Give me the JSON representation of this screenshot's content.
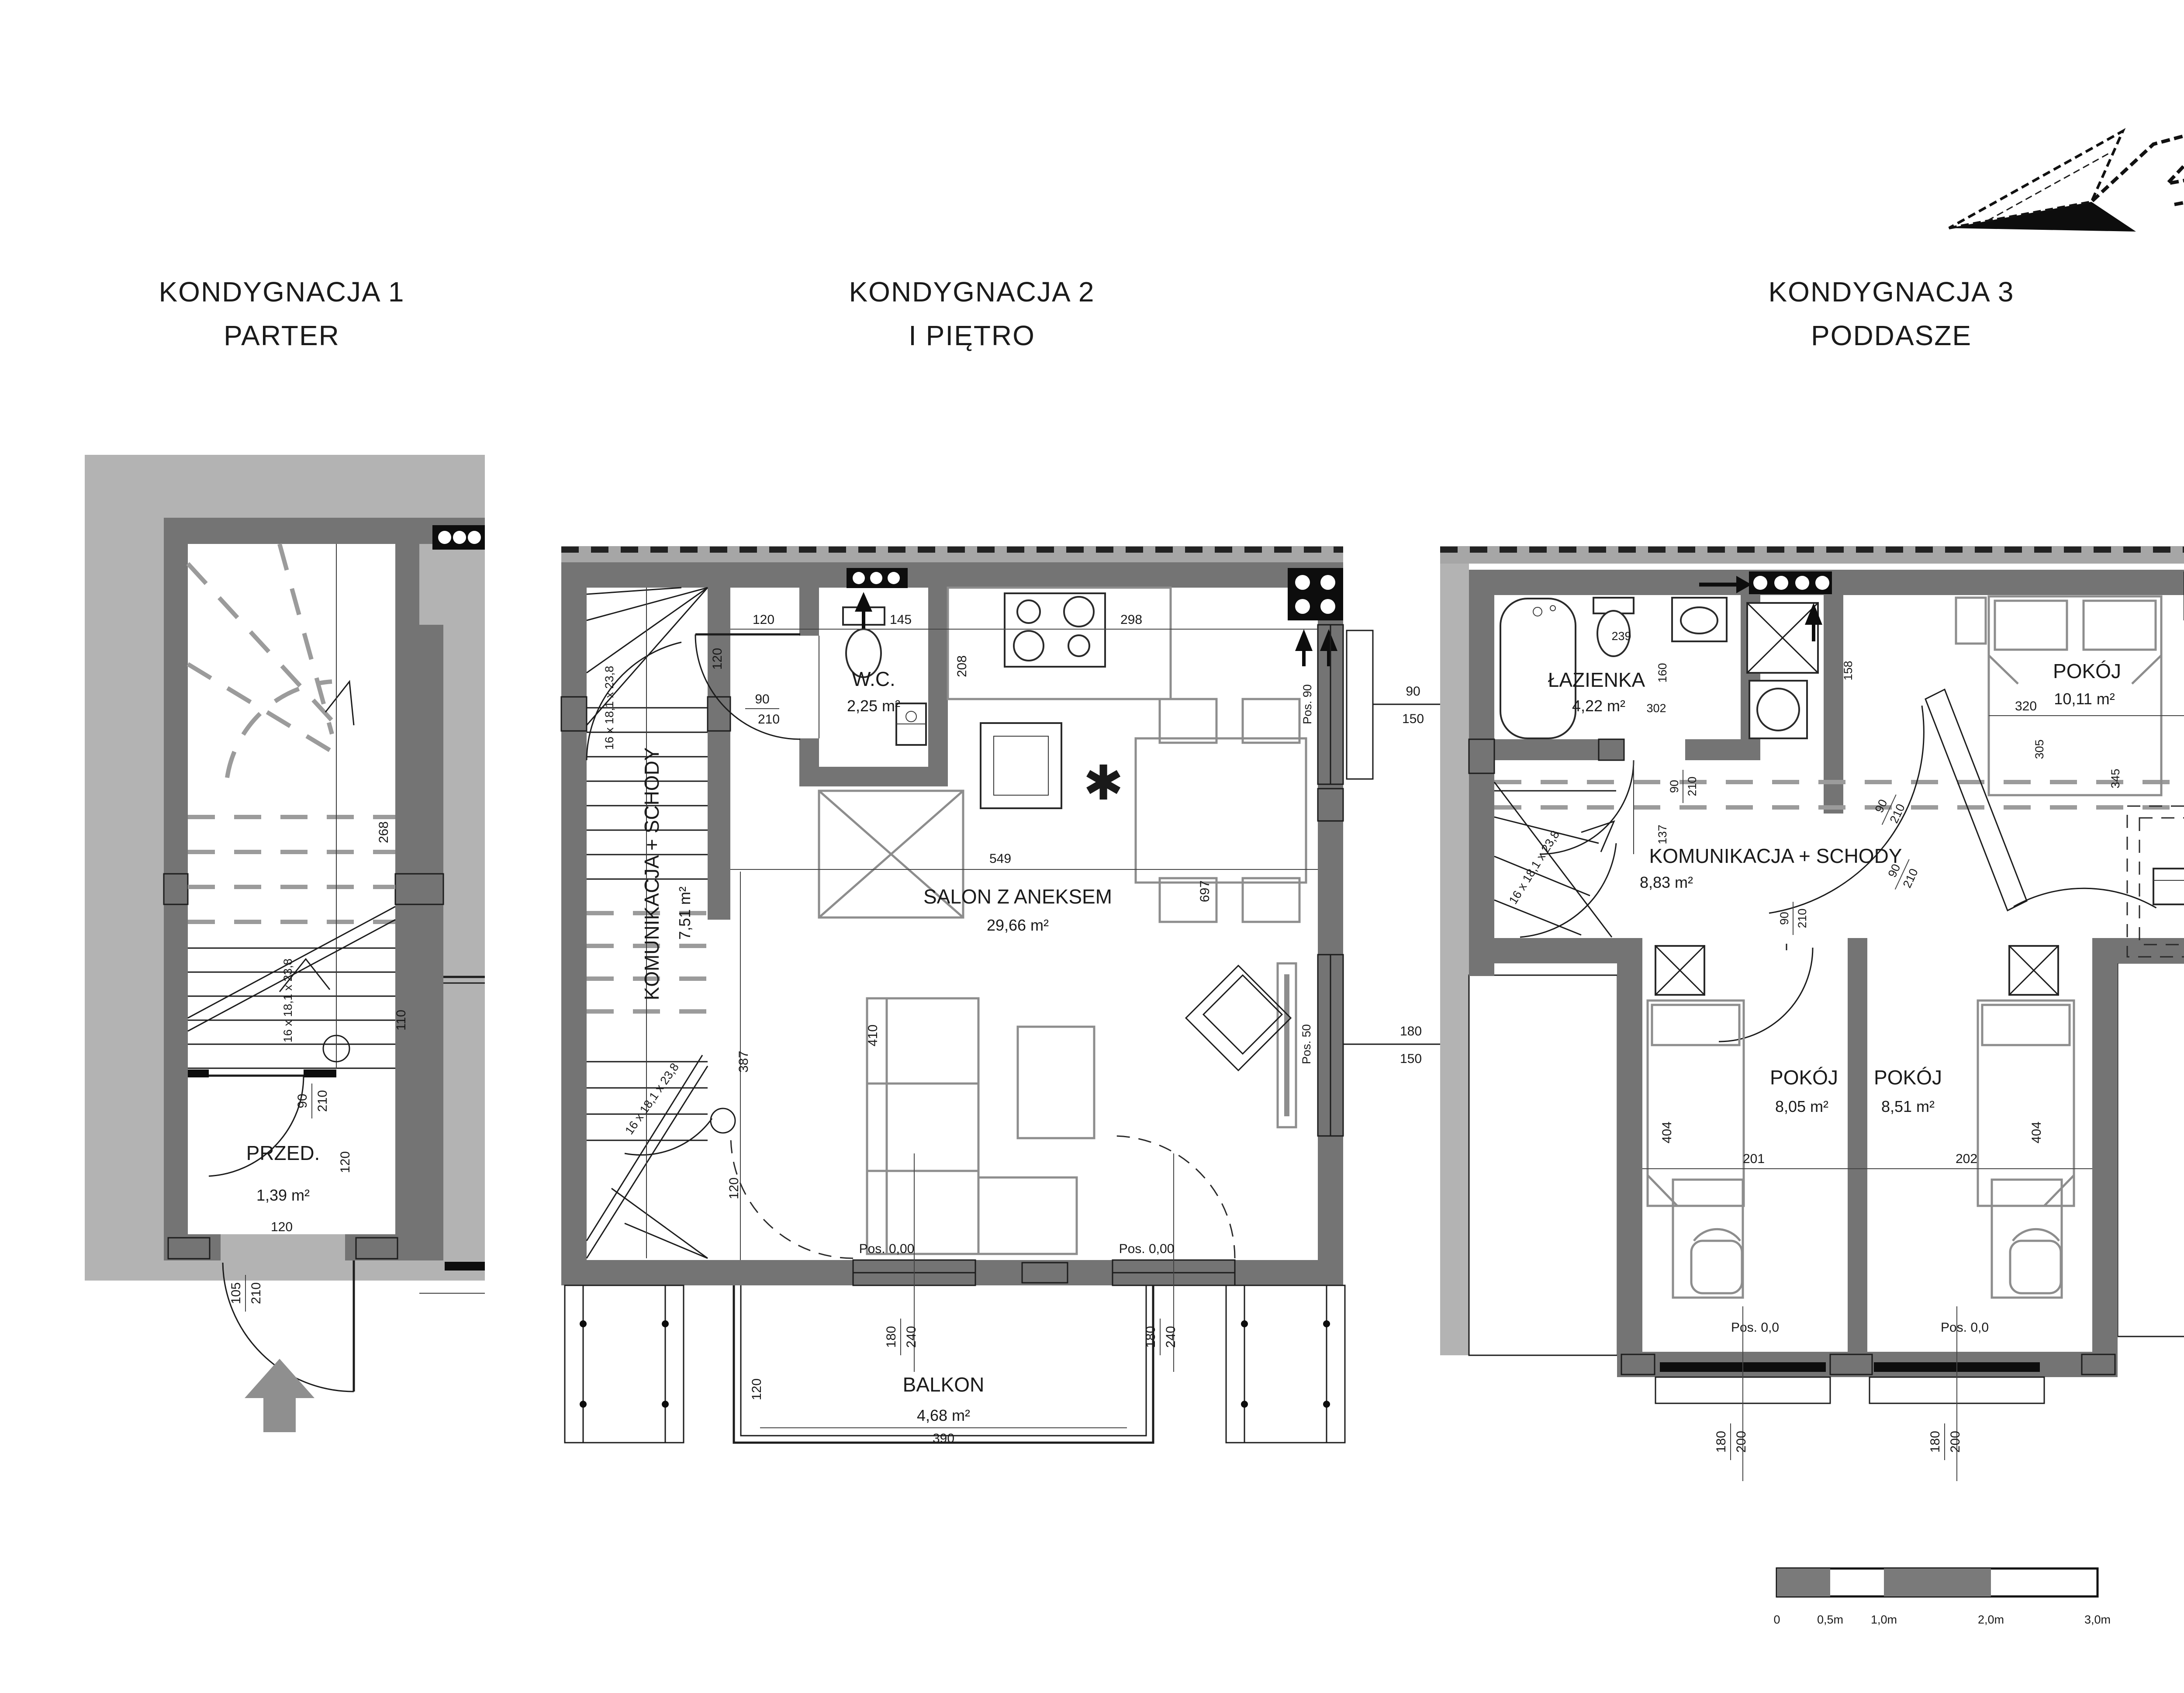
{
  "titles": [
    {
      "line1": "KONDYGNACJA 1",
      "line2": "PARTER"
    },
    {
      "line1": "KONDYGNACJA 2",
      "line2": "I PIĘTRO"
    },
    {
      "line1": "KONDYGNACJA 3",
      "line2": "PODDASZE"
    }
  ],
  "stair_formula": "16 x 18,1 x 23,8",
  "floor1": {
    "room": "PRZED.",
    "room_area": "1,39 m²",
    "dim_268": "268",
    "dim_110": "110",
    "dim_120_v": "120",
    "dim_120_h": "120",
    "door_w": "90",
    "door_h": "210",
    "entry_w": "105",
    "entry_h": "210"
  },
  "floor2": {
    "wc": "W.C.",
    "wc_area": "2,25 m²",
    "salon": "SALON Z ANEKSEM",
    "salon_area": "29,66 m²",
    "komunikacja": "KOMUNIKACJA + SCHODY",
    "komunikacja_area": "7,51 m²",
    "balkon": "BALKON",
    "balkon_area": "4,68 m²",
    "dim_120_top": "120",
    "dim_145": "145",
    "dim_298": "298",
    "dim_120_wc": "120",
    "dim_208": "208",
    "dim_549": "549",
    "dim_697": "697",
    "dim_387": "387",
    "dim_410": "410",
    "dim_120_door": "120",
    "dim_390": "390",
    "dim_120_balkon": "120",
    "wc_door_w": "90",
    "wc_door_h": "210",
    "win1_w": "90",
    "win1_h": "150",
    "win1_pos": "Pos. 90",
    "win2_w": "180",
    "win2_h": "150",
    "win2_pos": "Pos. 50",
    "bdoor_w": "180",
    "bdoor_h": "240",
    "level": "Pos. 0,00"
  },
  "floor3": {
    "lazienka": "ŁAZIENKA",
    "lazienka_area": "4,22 m²",
    "pokoj": "POKÓJ",
    "pokoj1_area": "10,11 m²",
    "pokoj2_area": "8,05 m²",
    "pokoj3_area": "8,51 m²",
    "komunikacja": "KOMUNIKACJA + SCHODY",
    "komunikacja_area": "8,83 m²",
    "dim_239": "239",
    "dim_160": "160",
    "dim_302": "302",
    "dim_158": "158",
    "dim_320": "320",
    "dim_305": "305",
    "dim_345": "345",
    "dim_137": "137",
    "dim_404": "404",
    "dim_201": "201",
    "dim_202": "202",
    "door_w": "90",
    "door_h": "210",
    "win1_w": "90",
    "win1_h": "200",
    "win1_pos": "Pos. 90",
    "bwin_w": "180",
    "bwin_h": "200",
    "level": "Pos. 0,0"
  },
  "scalebar": {
    "l0": "0",
    "l05": "0,5m",
    "l10": "1,0m",
    "l20": "2,0m",
    "l30": "3,0m"
  }
}
